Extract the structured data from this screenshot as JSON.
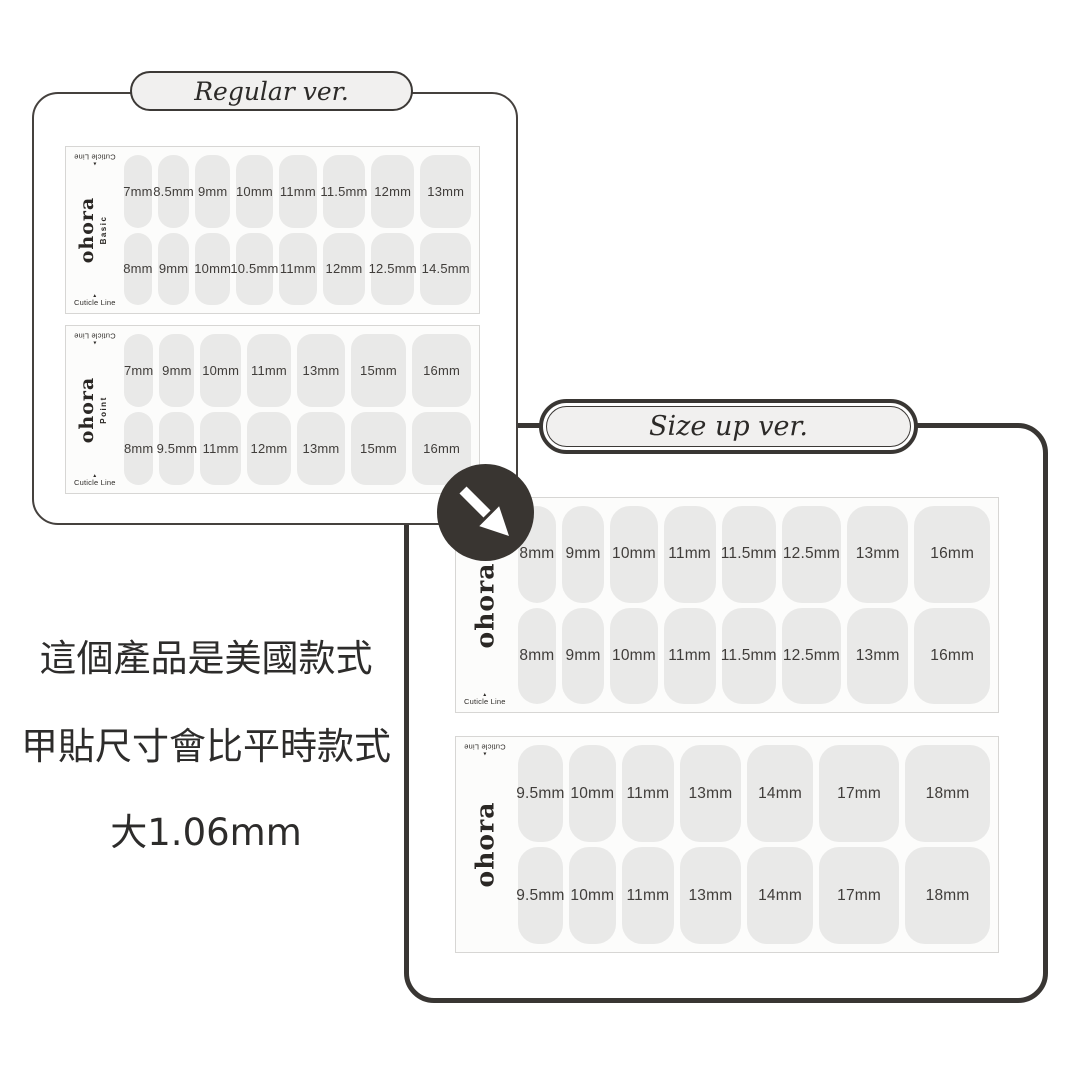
{
  "colors": {
    "card_border_dark": "#393633",
    "card_border_regular": "#45413e",
    "panel_border": "#d7d6d4",
    "nail_fill": "#e9e9e8",
    "pill_fill": "#f1f0ef",
    "badge_fill": "#393531",
    "text_dark": "#2d2c2b"
  },
  "labels": {
    "cuticle_line": "Cuticle Line",
    "brand": "ohora"
  },
  "regular_card": {
    "title": "Regular ver.",
    "panels": [
      {
        "brand": "ohora",
        "line": "Basic",
        "row1": [
          "7mm",
          "8.5mm",
          "9mm",
          "10mm",
          "11mm",
          "11.5mm",
          "12mm",
          "13mm"
        ],
        "row2": [
          "8mm",
          "9mm",
          "10mm",
          "10.5mm",
          "11mm",
          "12mm",
          "12.5mm",
          "14.5mm"
        ]
      },
      {
        "brand": "ohora",
        "line": "Point",
        "row1": [
          "7mm",
          "9mm",
          "10mm",
          "11mm",
          "13mm",
          "15mm",
          "16mm"
        ],
        "row2": [
          "8mm",
          "9.5mm",
          "11mm",
          "12mm",
          "13mm",
          "15mm",
          "16mm"
        ]
      }
    ]
  },
  "sizeup_card": {
    "title": "Size up ver.",
    "panels": [
      {
        "brand": "ohora",
        "row1": [
          "8mm",
          "9mm",
          "10mm",
          "11mm",
          "11.5mm",
          "12.5mm",
          "13mm",
          "16mm"
        ],
        "row2": [
          "8mm",
          "9mm",
          "10mm",
          "11mm",
          "11.5mm",
          "12.5mm",
          "13mm",
          "16mm"
        ]
      },
      {
        "brand": "ohora",
        "row1": [
          "9.5mm",
          "10mm",
          "11mm",
          "13mm",
          "14mm",
          "17mm",
          "18mm"
        ],
        "row2": [
          "9.5mm",
          "10mm",
          "11mm",
          "13mm",
          "14mm",
          "17mm",
          "18mm"
        ]
      }
    ]
  },
  "badge": {
    "icon": "arrow-down-right"
  },
  "caption": {
    "line1": "這個產品是美國款式",
    "line2": "甲貼尺寸會比平時款式",
    "line3": "大1.06mm"
  }
}
